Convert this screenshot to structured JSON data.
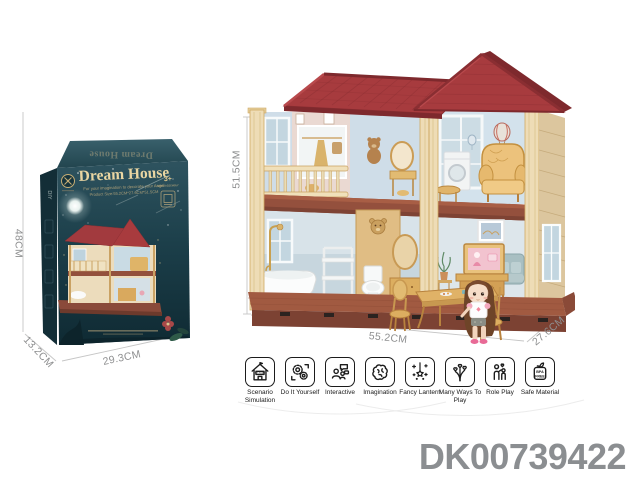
{
  "product_code": "DK00739422",
  "box": {
    "title": "Dream House",
    "top_flap_title": "Dream House",
    "subtitle_line1": "For your imagination to decorate your Angel",
    "subtitle_line2": "Product Size:55.2CM*27.6CM*51.5CM",
    "age_badge": "3+",
    "age_badge_note": "NEED ASSEMBLY",
    "spine_text": "DIY",
    "dim_height": "48CM",
    "dim_width": "29.3CM",
    "dim_depth": "13.2CM"
  },
  "house": {
    "dim_height": "51.5CM",
    "dim_width": "55.2CM",
    "dim_depth": "27.6CM"
  },
  "features": [
    {
      "label": "Scenario Simulation",
      "icon": "scenario-simulation-house-icon",
      "icon_text": "MY HOME"
    },
    {
      "label": "Do It Yourself",
      "icon": "diy-gear-puzzle-icon"
    },
    {
      "label": "Interactive",
      "icon": "interactive-people-chat-icon"
    },
    {
      "label": "Imagination",
      "icon": "imagination-brain-icon"
    },
    {
      "label": "Fancy Lantern",
      "icon": "fancy-lantern-star-icon"
    },
    {
      "label": "Many Ways To Play",
      "icon": "many-ways-hearts-icon"
    },
    {
      "label": "Role Play",
      "icon": "role-play-family-icon"
    },
    {
      "label": "Safe Material",
      "icon": "bpa-free-badge-icon",
      "badge_line1": "BPA",
      "badge_line2": "FREE"
    }
  ],
  "colors": {
    "roof_red": "#a73b3e",
    "pillar_cream": "#eedcb6",
    "platform_brown": "#7c4233",
    "box_teal": "#1c3f4a",
    "gold_text": "#ead6a2",
    "dim_text": "#8e8f90",
    "code_text": "#8b8e91"
  }
}
